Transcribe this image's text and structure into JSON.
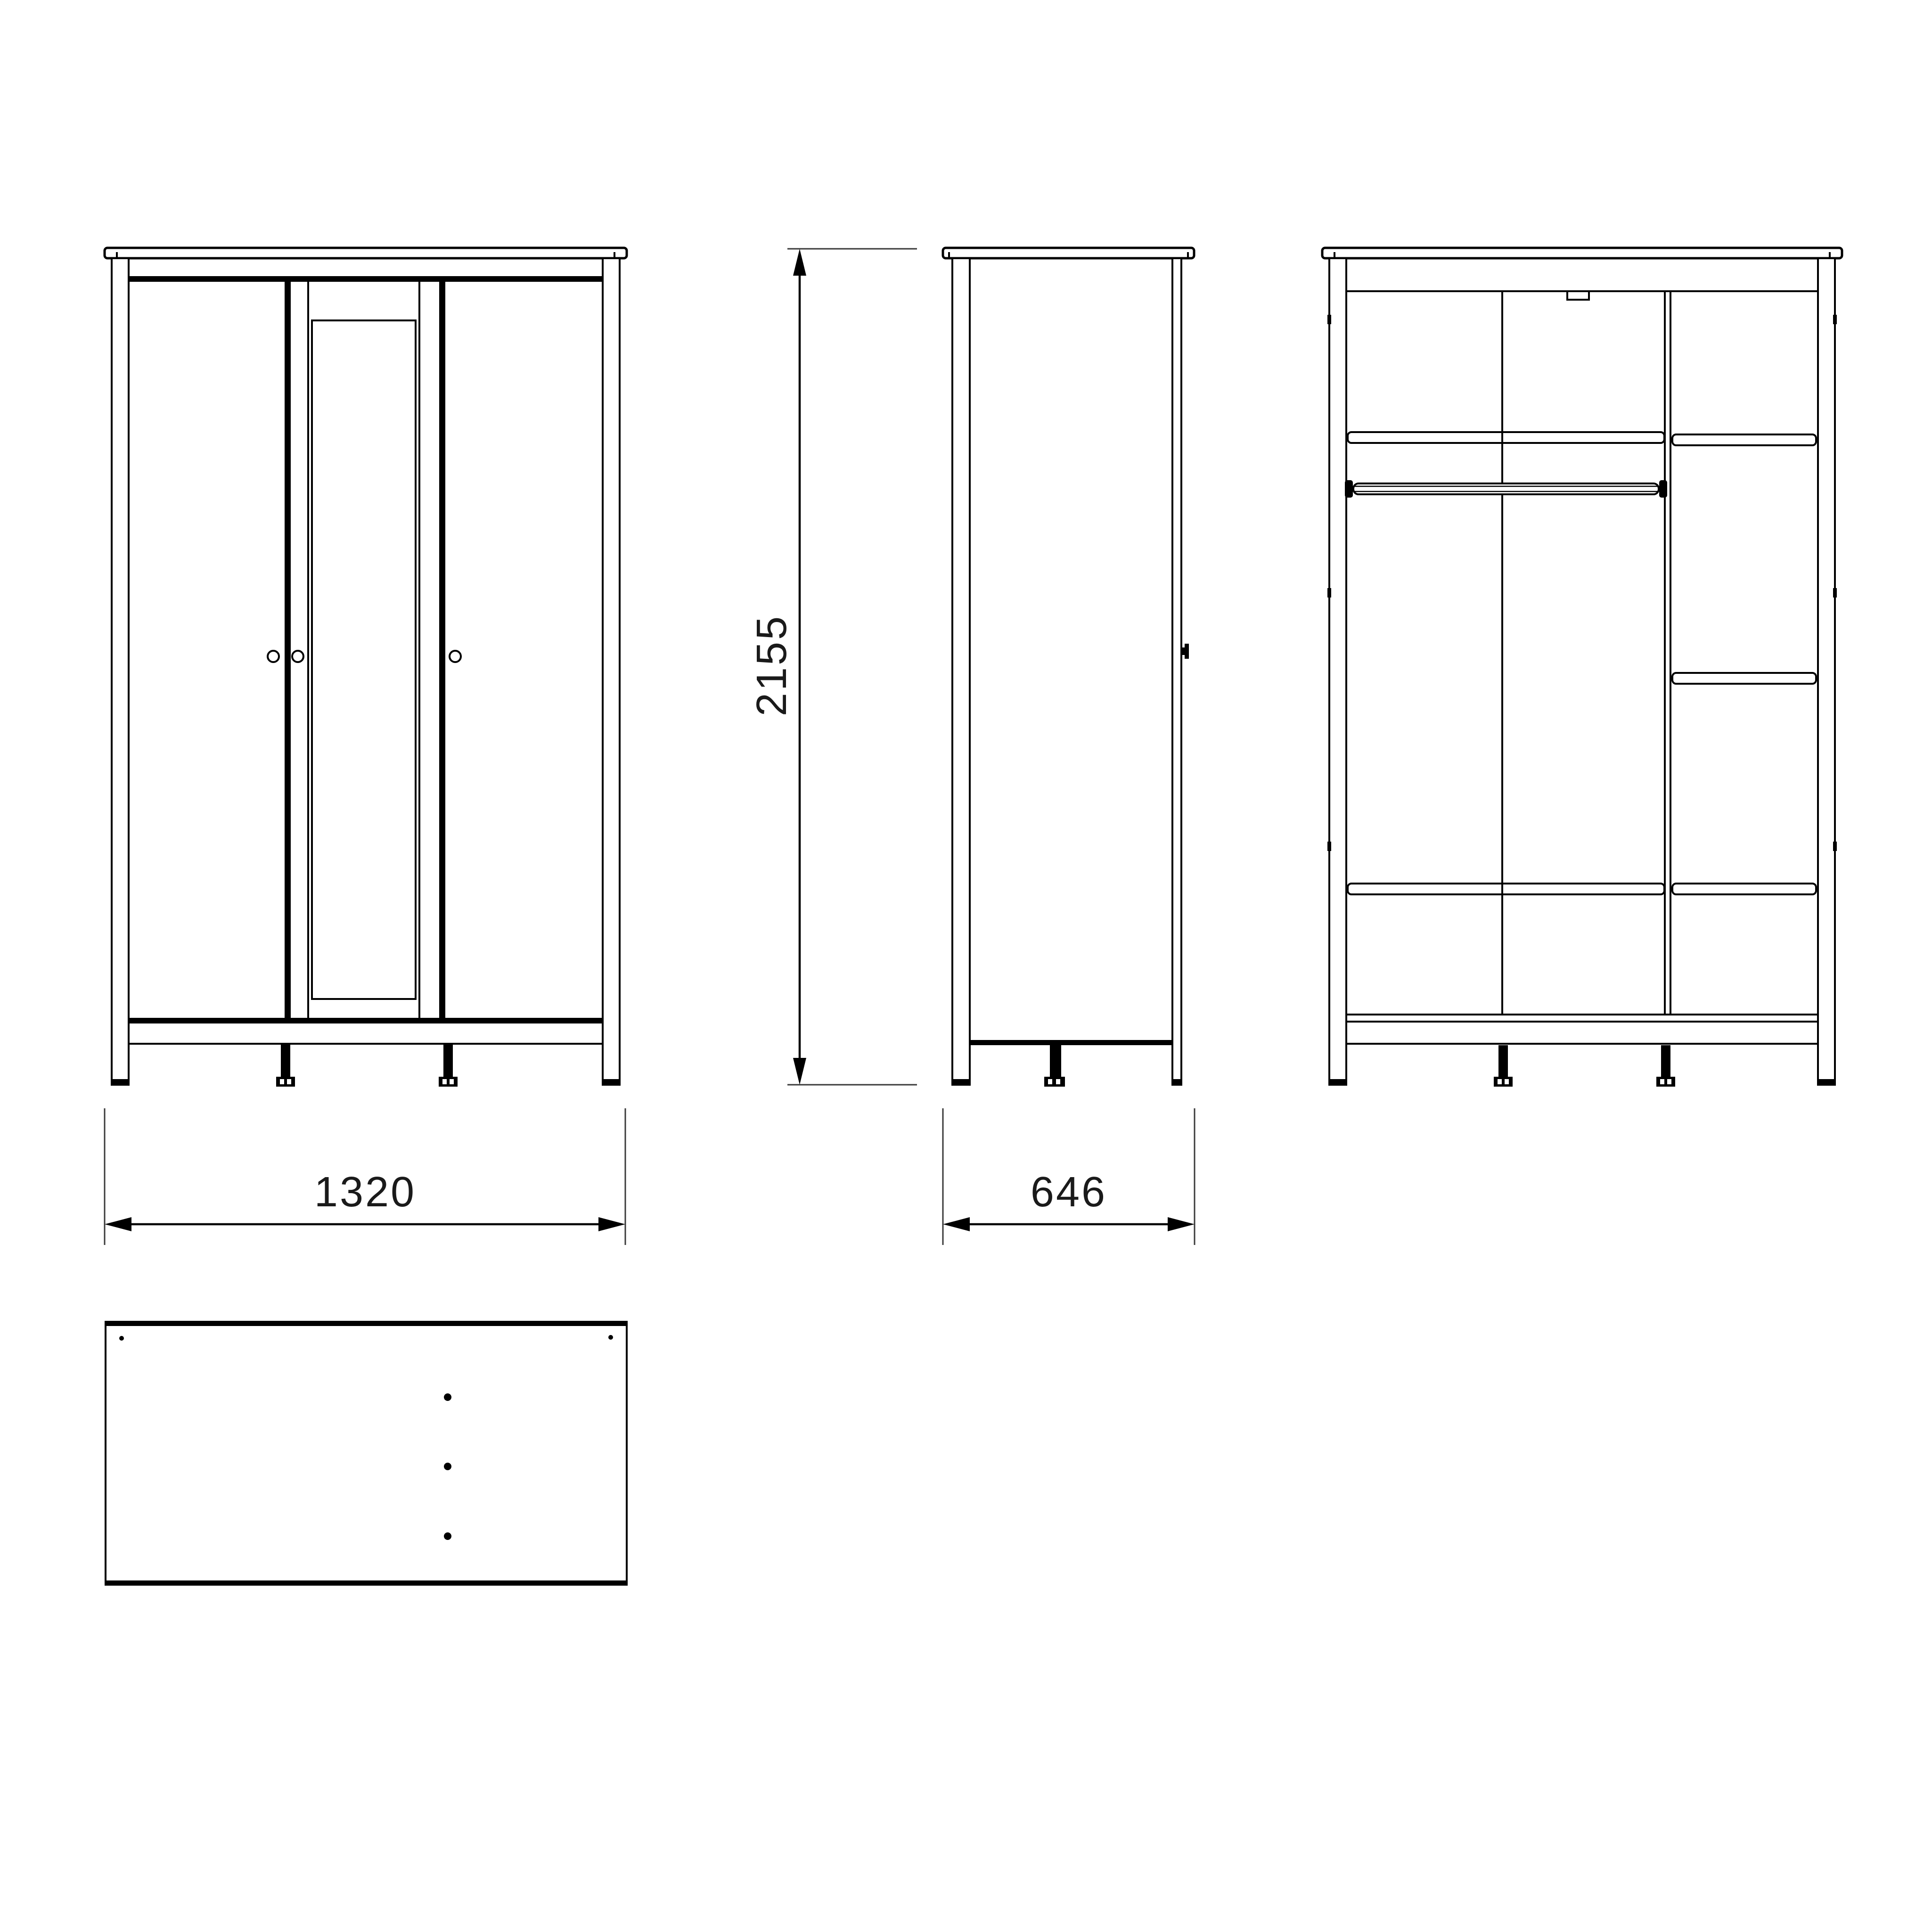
{
  "colors": {
    "background": "#ffffff",
    "line": "#000000",
    "dim_text": "#1a1a1a"
  },
  "dimensions": {
    "width_label": "1320",
    "depth_label": "646",
    "height_label": "2155"
  }
}
